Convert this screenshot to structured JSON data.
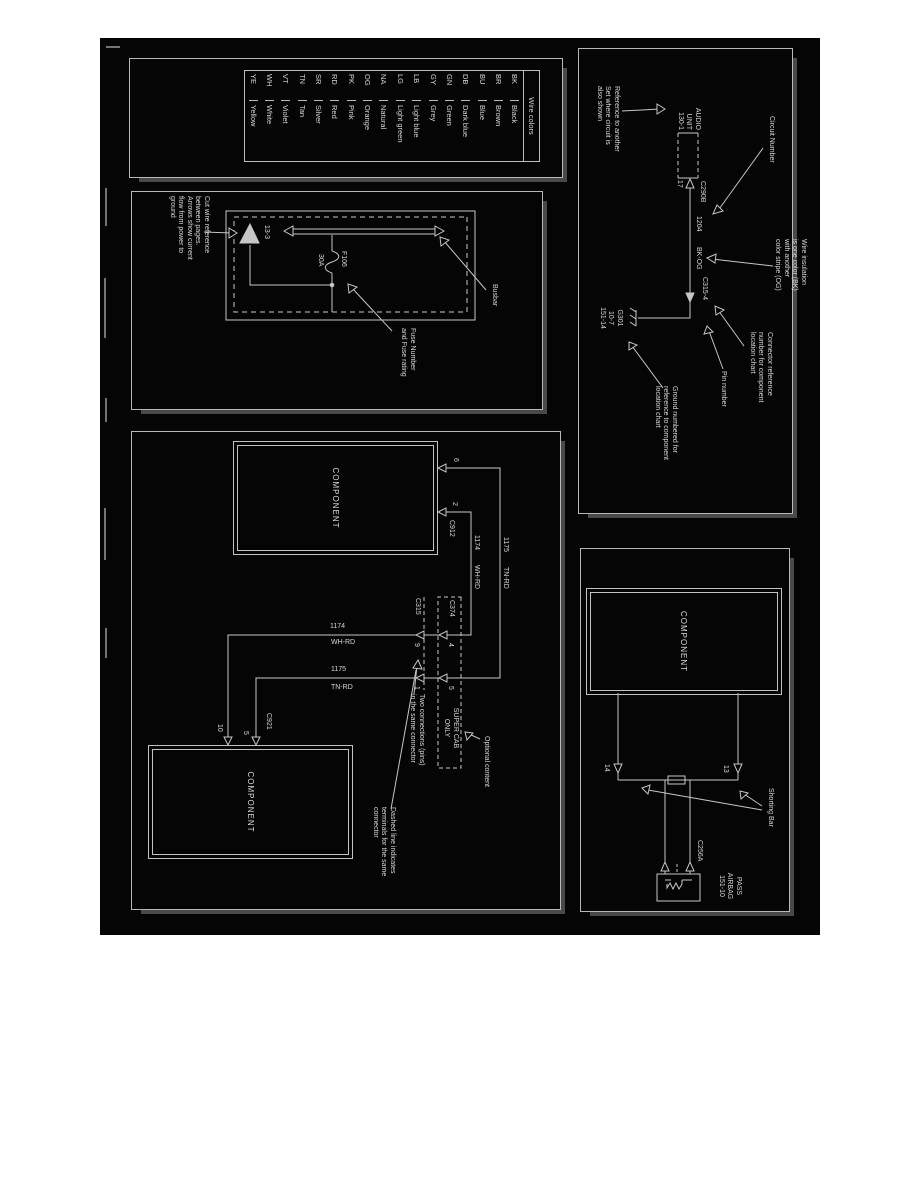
{
  "wire_colors": {
    "title": "Wire colors",
    "rows": [
      {
        "code": "BK",
        "name": "Black"
      },
      {
        "code": "BR",
        "name": "Brown"
      },
      {
        "code": "BU",
        "name": "Blue"
      },
      {
        "code": "DB",
        "name": "Dark blue"
      },
      {
        "code": "GN",
        "name": "Green"
      },
      {
        "code": "GY",
        "name": "Grey"
      },
      {
        "code": "LB",
        "name": "Light blue"
      },
      {
        "code": "LG",
        "name": "Light green"
      },
      {
        "code": "NA",
        "name": "Natural"
      },
      {
        "code": "OG",
        "name": "Orange"
      },
      {
        "code": "PK",
        "name": "Pink"
      },
      {
        "code": "RD",
        "name": "Red"
      },
      {
        "code": "SR",
        "name": "Silver"
      },
      {
        "code": "TN",
        "name": "Tan"
      },
      {
        "code": "VT",
        "name": "Violet"
      },
      {
        "code": "WH",
        "name": "White"
      },
      {
        "code": "YE",
        "name": "Yellow"
      }
    ]
  },
  "circuit": {
    "component": "AUDIO\nUNIT\n130-1",
    "ref_note": "Reference to another\nSet where circuit is\nalso shown",
    "circuit_number_label": "Circuit Number",
    "connector": "C290B",
    "pin": "17",
    "circuit_no": "1204",
    "wire_color": "BK-OG",
    "connector2": "C315-4",
    "insulation_note": "Wire insulation\nis one color (BK)\nwith another\ncolor stripe (OG)",
    "connector_note": "Connector reference\nnumber for component\nlocation chart",
    "pin_number_label": "Pin number",
    "ground_note": "Ground numbered for\nreference to component\nlocation chart",
    "ground_id": "G301\n10-7\n151-14"
  },
  "fuse": {
    "cut_note": "Cut wire reference\nbetween pages.\nArrows show current\nflow from power to\nground",
    "page_ref": "13-3",
    "fuse_id": "F106",
    "fuse_rating": "30A",
    "busbar_label": "Busbar",
    "fuse_note": "Fuse Number\nand Fuse rating"
  },
  "harness": {
    "component1": "COMPONENT",
    "component2": "COMPONENT",
    "c912": "C912",
    "pin6": "6",
    "pin2": "2",
    "w1175": "1175",
    "tnrd": "TN-RD",
    "w1174": "1174",
    "whrd": "WH-RD",
    "v1174": "1174",
    "vwhrd": "WH-RD",
    "v1175": "1175",
    "vtnrd": "TN-RD",
    "c374": "C374",
    "super_cab": "SUPER CAB\nONLY",
    "pin4": "4",
    "pin5b": "5",
    "c315": "C315",
    "pin9": "9",
    "pin1": "1",
    "two_conn_note": "Two connections (pins)\nin the same connector",
    "optional_note": "Optional content",
    "dashed_note": "Dashed line indicates\nterminals for the same\nconnector",
    "c921": "C921",
    "pin5": "5",
    "pin10": "10"
  },
  "shorting": {
    "component": "COMPONENT",
    "pin13": "13",
    "pin14": "14",
    "label": "Shorting Bar",
    "connector": "C256A",
    "airbag": "PASS\nAIRBAG\n151-10"
  }
}
